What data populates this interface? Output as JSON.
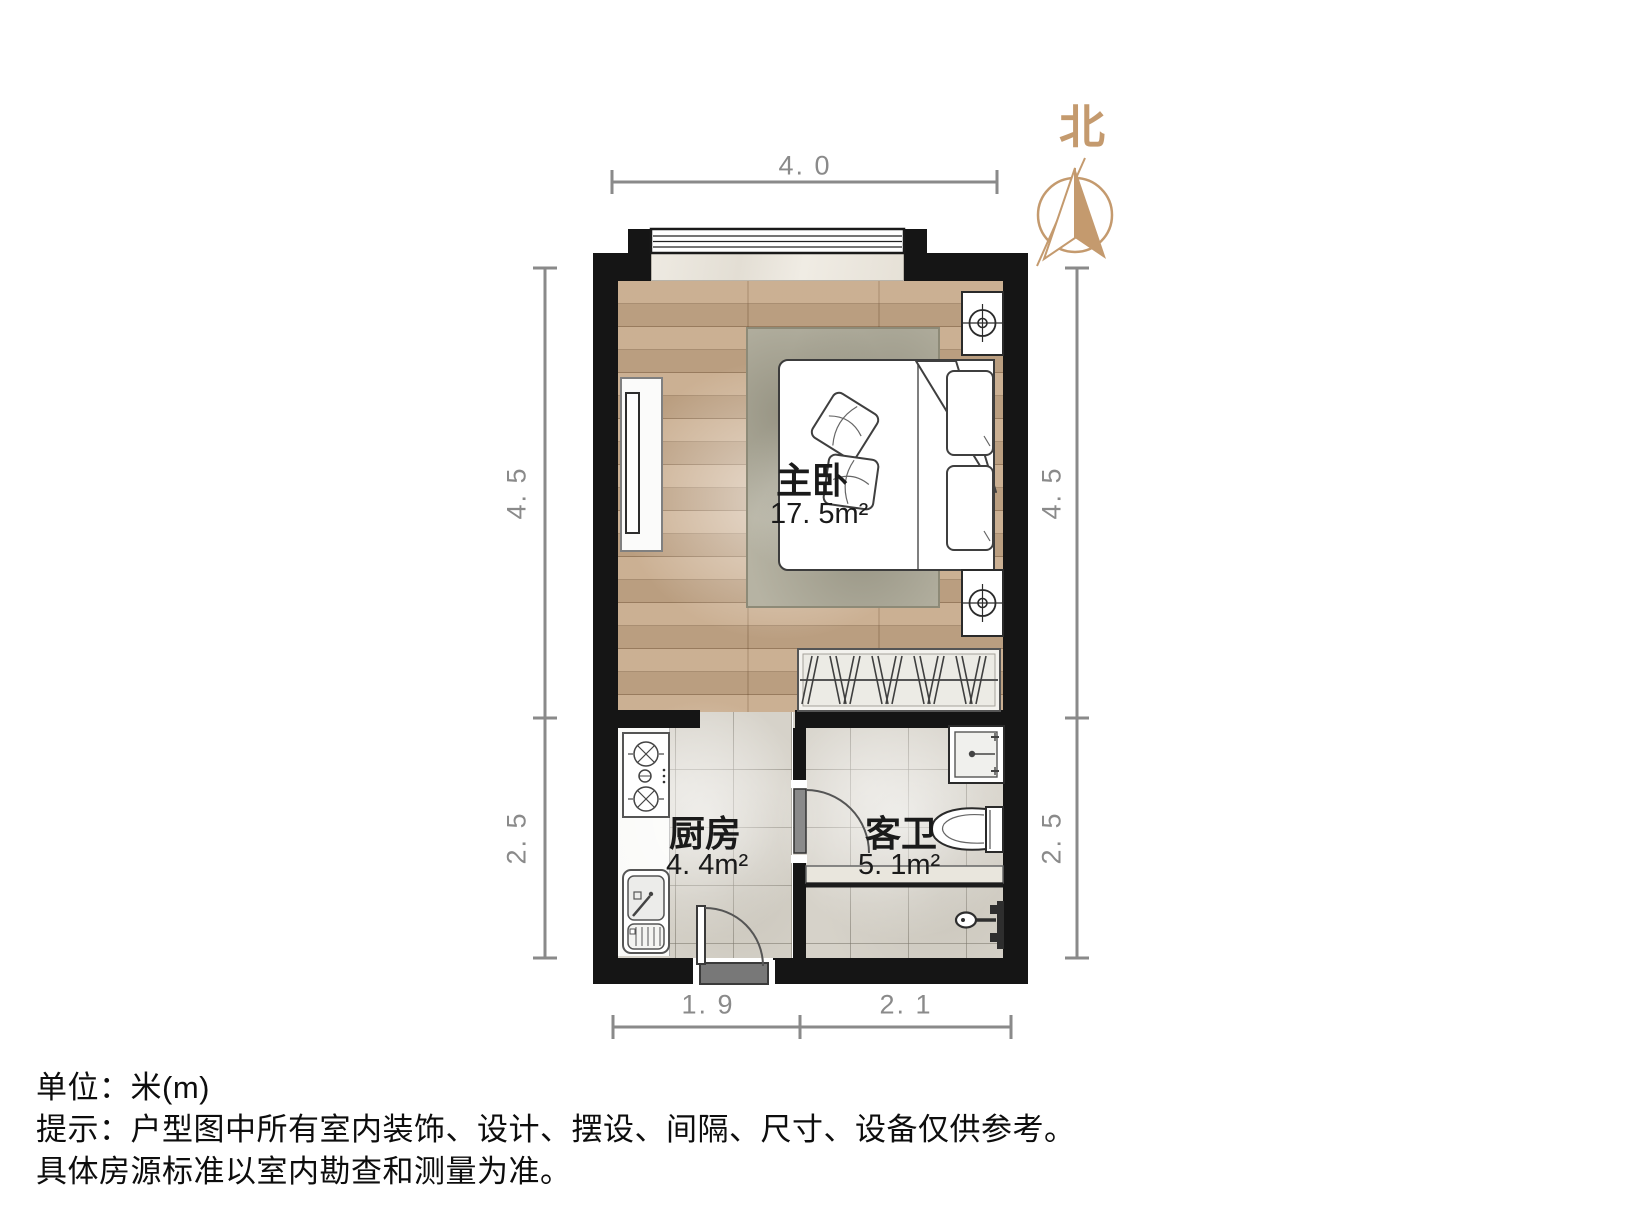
{
  "floorplan": {
    "north_label": "北",
    "rooms": [
      {
        "name": "主卧",
        "area": "17. 5m²"
      },
      {
        "name": "厨房",
        "area": "4. 4m²"
      },
      {
        "name": "客卫",
        "area": "5. 1m²"
      }
    ],
    "dimensions": {
      "top": "4. 0",
      "left_upper": "4. 5",
      "left_lower": "2. 5",
      "right_upper": "4. 5",
      "right_lower": "2. 5",
      "bottom_left": "1. 9",
      "bottom_right": "2. 1"
    }
  },
  "footer": {
    "line1": "单位：米(m)",
    "line2": "提示：户型图中所有室内装饰、设计、摆设、间隔、尺寸、设备仅供参考。",
    "line3": "具体房源标准以室内勘查和测量为准。"
  },
  "colors": {
    "wall": "#151515",
    "wood_floor": "#c6a888",
    "tile_floor": "#d6d2c9",
    "north_accent": "#c49a6e",
    "dimension_gray": "#8a8a8a",
    "label_text": "#1a1a1a"
  }
}
